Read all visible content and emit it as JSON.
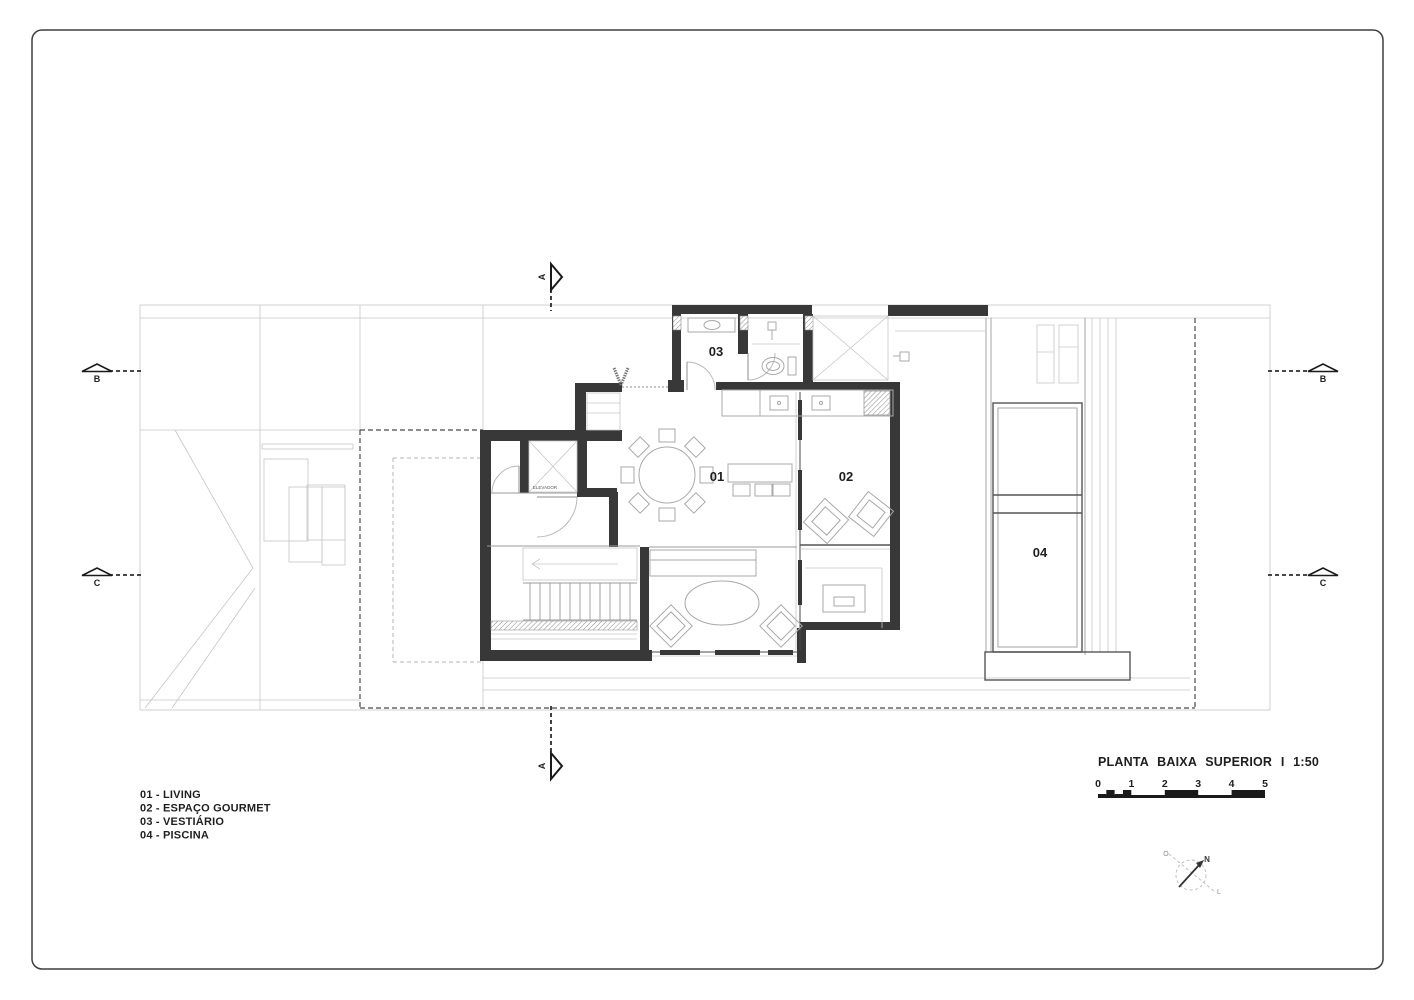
{
  "sheet": {
    "title": "PLANTA BAIXA SUPERIOR I 1:50",
    "scale_ticks": [
      "0",
      "1",
      "2",
      "3",
      "4",
      "5"
    ],
    "legend_items": [
      "01 - LIVING",
      "02 - ESPAÇO GOURMET",
      "03 - VESTIÁRIO",
      "04 - PISCINA"
    ],
    "room_labels": {
      "living": "01",
      "gourmet": "02",
      "vestiario": "03",
      "piscina": "04"
    },
    "elevator_label": "ELEVADOR",
    "section_a": "A",
    "section_b": "B",
    "section_c": "C",
    "compass": {
      "north": "N",
      "west": "O",
      "east": "L"
    }
  },
  "colors": {
    "wall": "#383838",
    "light_line": "#c6c6c6",
    "medium_line": "#9b9b9b",
    "dashed_boundary": "#4a4a4a",
    "text": "#1f1f1f"
  }
}
